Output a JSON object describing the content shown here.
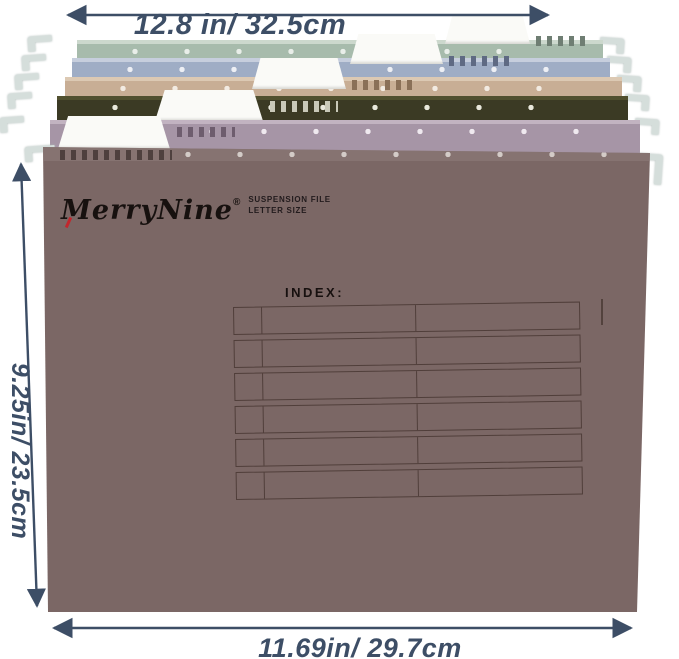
{
  "dimensions": {
    "top_width": "12.8 in/ 32.5cm",
    "left_height": "9.25in/ 23.5cm",
    "bottom_width": "11.69in/ 29.7cm"
  },
  "product": {
    "brand": "MerryNine",
    "registered_mark": "®",
    "subtitle_line1": "SUSPENSION FILE",
    "subtitle_line2": "LETTER SIZE",
    "index_label": "INDEX:"
  },
  "index_table": {
    "rows": 6,
    "columns": 3
  },
  "folders": [
    {
      "name": "sage-green",
      "body": "#a7bbac",
      "edge": "#ccd8cd",
      "slot": "#6f7e73",
      "dot": "#e9eee9"
    },
    {
      "name": "blue-gray",
      "body": "#9fadc5",
      "edge": "#c6cedd",
      "slot": "#5f6a83",
      "dot": "#edeff4"
    },
    {
      "name": "tan",
      "body": "#c8ae95",
      "edge": "#dcc9b3",
      "slot": "#8a7058",
      "dot": "#f2ebe2"
    },
    {
      "name": "dark-olive",
      "body": "#3b3a24",
      "edge": "#51502f",
      "slot": "#c9c9b9",
      "dot": "#e8e8dc"
    },
    {
      "name": "lavender",
      "body": "#a695a6",
      "edge": "#c2b3c1",
      "slot": "#6e5d6e",
      "dot": "#efe9ef"
    },
    {
      "name": "mauve-front",
      "body": "#7b6765",
      "edge": "#8f7d7b",
      "slot": "#4e403e",
      "dot": "#d3cbc7"
    }
  ],
  "colors": {
    "arrow": "#3d4e66",
    "logo_text": "#17110f",
    "logo_accent": "#c2272d",
    "table_line": "#463530",
    "tab": "#fafaf7",
    "hook": "#d5dedb",
    "hook_outline": "#a9b6b3",
    "background": "#ffffff"
  }
}
